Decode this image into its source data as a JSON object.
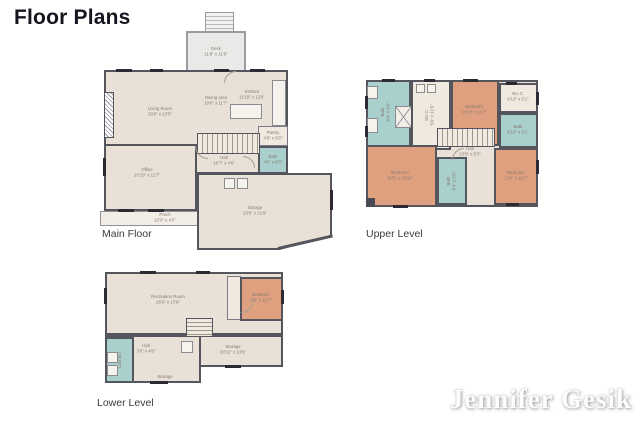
{
  "page": {
    "title": "Floor Plans",
    "watermark": "Jennifer Gesik"
  },
  "palette": {
    "wall": "#54555d",
    "floor_beige": "#e9e1d7",
    "floor_light": "#efe9e0",
    "bedroom_orange": "#dfa080",
    "bath_teal": "#a9d0cd",
    "deck_gray": "#e9e9e7",
    "label_text": "#85796c",
    "watermark_color": "#fdfdfd"
  },
  "floors": {
    "main": {
      "label": "Main Floor",
      "rooms": [
        {
          "name": "Deck",
          "dims": "11'8\" x 11'8\""
        },
        {
          "name": "Living Room",
          "dims": "20'6\" x 13'5\""
        },
        {
          "name": "Dining area",
          "dims": "10'6\" x 11'7\""
        },
        {
          "name": "Kitchen",
          "dims": "11'10\" x 12'6\""
        },
        {
          "name": "Hall",
          "dims": "10'7\" x 4'6\""
        },
        {
          "name": "Office",
          "dims": "10'10\" x 11'7\""
        },
        {
          "name": "Pantry",
          "dims": "4'0\" x 5'0\""
        },
        {
          "name": "Bath",
          "dims": "4'0\" x 5'0\""
        },
        {
          "name": "Porch",
          "dims": "22'0\" x 4'0\""
        },
        {
          "name": "Garage",
          "dims": "23'6\" x 21'9\""
        }
      ]
    },
    "upper": {
      "label": "Upper Level",
      "rooms": [
        {
          "name": "Bath",
          "dims": "8'9\" x 9'6\""
        },
        {
          "name": "W.I.C.",
          "dims": "5'0\" x 11'6\""
        },
        {
          "name": "Bedroom",
          "dims": "11'10\" x 11'7\""
        },
        {
          "name": "W.I.C.",
          "dims": "8'10\" x 5'1\""
        },
        {
          "name": "Bath",
          "dims": "8'10\" x 5'1\""
        },
        {
          "name": "Bedroom",
          "dims": "13'4\" x 11'7\""
        },
        {
          "name": "Bedroom",
          "dims": "16'5\" x 13'10\""
        },
        {
          "name": "Hall",
          "dims": "13'0\" x 6'3\""
        },
        {
          "name": "Bath",
          "dims": "8'4\" x 5'0\""
        }
      ]
    },
    "lower": {
      "label": "Lower Level",
      "rooms": [
        {
          "name": "Recreation Room",
          "dims": "26'0\" x 13'8\""
        },
        {
          "name": "Bedroom",
          "dims": "9'6\" x 11'7\""
        },
        {
          "name": "Laundry",
          "dims": ""
        },
        {
          "name": "Hall",
          "dims": "3'6\" x 4'6\""
        },
        {
          "name": "Storage",
          "dims": "20'11\" x 13'6\""
        },
        {
          "name": "Storage",
          "dims": ""
        }
      ]
    }
  }
}
